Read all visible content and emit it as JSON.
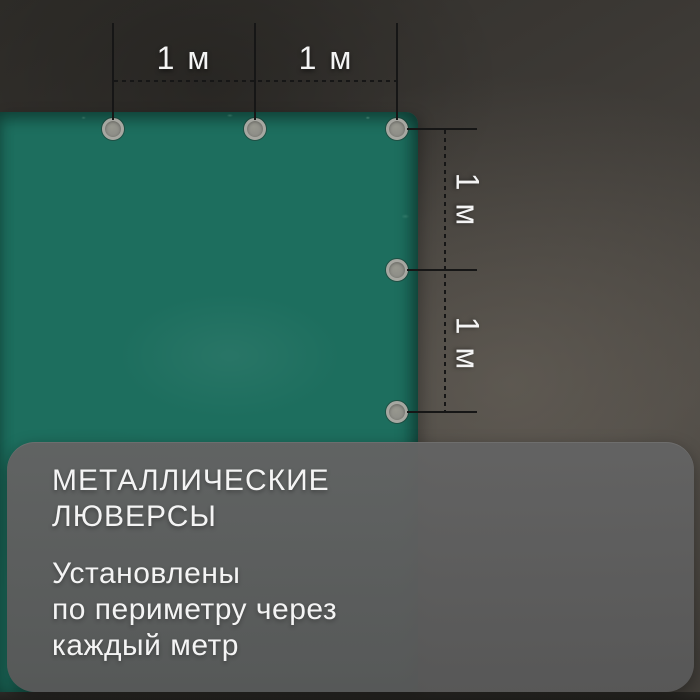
{
  "colors": {
    "tarp": "#1d6e5e",
    "background_light": "#5a564f",
    "background_dark": "#2f2d29",
    "card_bg": "#5e5e5e",
    "text": "#f4f4f4",
    "line": "#161616",
    "grommet_fill": "#8e8e88",
    "grommet_ring": "#a7a7a1",
    "bottom_strip": "#22211e"
  },
  "dimension_labels": {
    "top": [
      {
        "label": "1 м"
      },
      {
        "label": "1 м"
      }
    ],
    "right": [
      {
        "label": "1 м"
      },
      {
        "label": "1 м"
      }
    ]
  },
  "info_card": {
    "title_lines": [
      "МЕТАЛЛИЧЕСКИЕ",
      "ЛЮВЕРСЫ"
    ],
    "body_lines": [
      "Установлены",
      "по периметру через",
      "каждый метр"
    ]
  }
}
